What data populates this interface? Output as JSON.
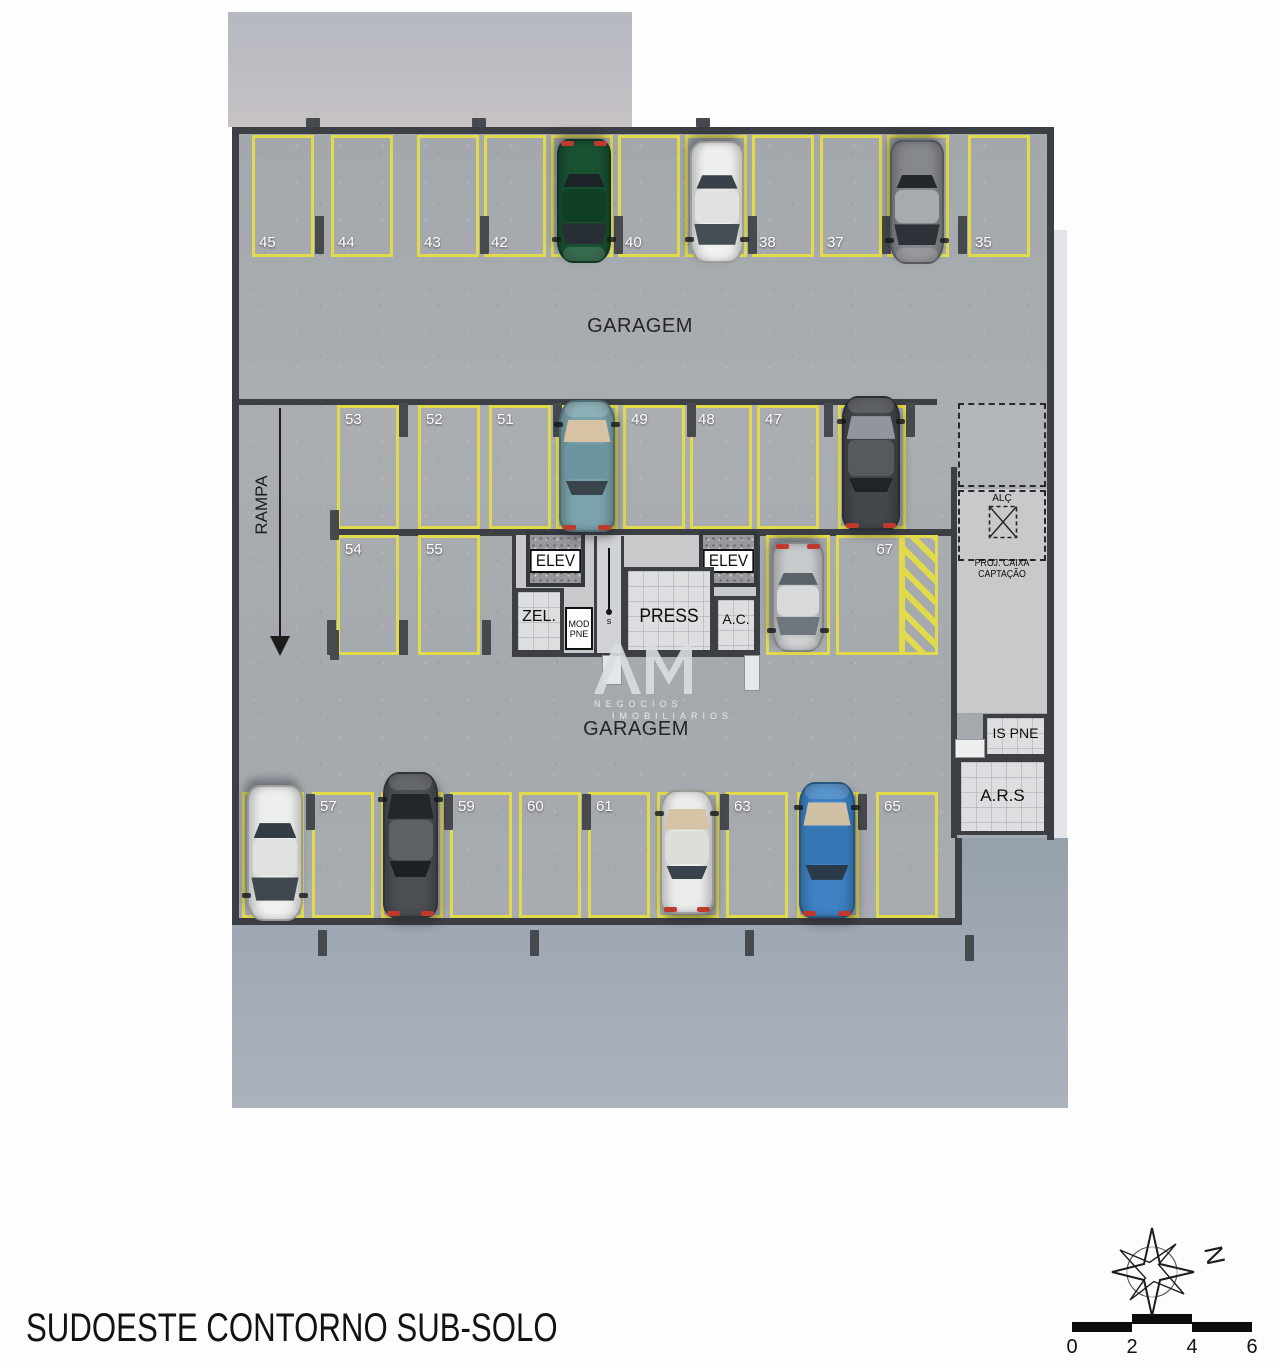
{
  "title": "SUDOESTE CONTORNO SUB-SOLO",
  "plan": {
    "garagem_top": "GARAGEM",
    "garagem_bottom": "GARAGEM",
    "rampa": "RAMPA",
    "core": {
      "elev": "ELEV",
      "zel": "ZEL.",
      "mod_line1": "MOD",
      "mod_line2": "PNE",
      "press": "PRESS",
      "ac": "A.C.",
      "stair_marker": "s"
    },
    "right_wing": {
      "alc": "ALÇ",
      "proj_caixa": "PROJ. CAIXA CAPTAÇÃO",
      "is_pne": "IS PNE",
      "ars": "A.R.S"
    },
    "rows": {
      "top": [
        "45",
        "44",
        "43",
        "42",
        "",
        "40",
        "",
        "38",
        "37",
        "",
        "35"
      ],
      "mid": [
        "53",
        "52",
        "51",
        "",
        "49",
        "48",
        "47",
        ""
      ],
      "sub": [
        "54",
        "55"
      ],
      "aux": [
        "",
        "67"
      ],
      "bottom": [
        "",
        "57",
        "",
        "59",
        "60",
        "61",
        "",
        "63",
        "",
        "65"
      ]
    }
  },
  "car_colors": {
    "green": {
      "body": "#185233",
      "roof": "#0f3f25",
      "glass": "#262d33",
      "glass2": "#1d2329"
    },
    "white": {
      "body": "#eef0ee",
      "roof": "#dfe2e0",
      "glass": "#454d55",
      "glass2": "#39414a"
    },
    "gsuv": {
      "body": "#85888d",
      "roof": "#a7abaf",
      "glass": "#2c3237",
      "glass2": "#23282d"
    },
    "teal": {
      "body": "#7ba3ad",
      "roof": "#6b96a1",
      "glass": "#d8c2a4",
      "glass2": "#39444b"
    },
    "dark": {
      "body": "#43474c",
      "roof": "#565a5f",
      "glass": "#90969c",
      "glass2": "#1f2429"
    },
    "silver": {
      "body": "#c7cacc",
      "roof": "#d7d9db",
      "glass": "#6f767d",
      "glass2": "#5a6168"
    },
    "white2": {
      "body": "#edefed",
      "roof": "#e0e2df",
      "glass": "#3f474f",
      "glass2": "#333b43"
    },
    "dsuv": {
      "body": "#4b4f54",
      "roof": "#5d6166",
      "glass": "#23272b",
      "glass2": "#1c2024"
    },
    "hatchw": {
      "body": "#eaece9",
      "roof": "#dcded9",
      "glass": "#d6c3a6",
      "glass2": "#3a434b"
    },
    "blue": {
      "body": "#3e82c4",
      "roof": "#3576b4",
      "glass": "#cfc0a6",
      "glass2": "#2a3a49"
    }
  },
  "watermark": {
    "logo": "AM",
    "line1": "NEGOCIOS",
    "line2": "IMOBILIARIOS"
  },
  "compass": {
    "north": "N"
  },
  "scalebar": {
    "ticks": [
      "0",
      "2",
      "4",
      "6"
    ]
  },
  "palette": {
    "floor": "#a6aaae",
    "apron": "#9aa3af",
    "wall": "#3c3f44",
    "stall_line": "#e1da4a",
    "tail_light": "#c0392e"
  }
}
